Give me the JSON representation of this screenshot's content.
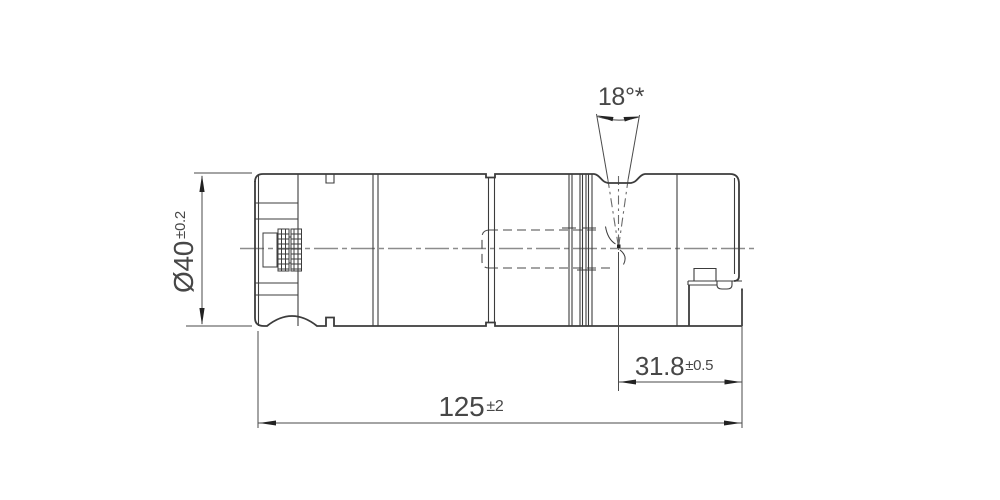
{
  "drawing": {
    "background": "#ffffff",
    "line_color": "#3c3c3c",
    "centerline_color": "#8c8c8c",
    "dimensions": {
      "angle": {
        "label": "18°*"
      },
      "diameter": {
        "value": "Ø40",
        "tolerance": "±0.2"
      },
      "length": {
        "value": "125",
        "tolerance": "±2"
      },
      "offset": {
        "value": "31.8",
        "tolerance": "±0.5"
      }
    }
  }
}
